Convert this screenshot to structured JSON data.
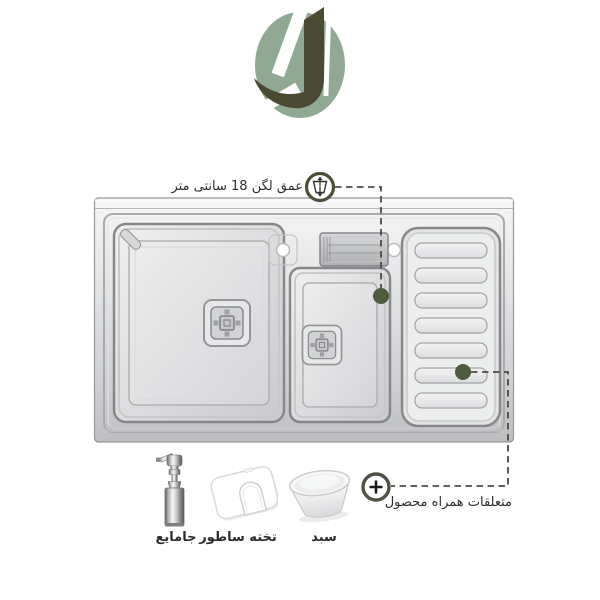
{
  "brand": {
    "logo_letter": "J",
    "logo_color_dark": "#4A4A33",
    "logo_color_sage": "#90A992"
  },
  "product": {
    "image": "stainless-steel-double-bowl-kitchen-sink-with-drainboard"
  },
  "callouts": {
    "depth": {
      "label": "عمق لگن 18 سانتی متر",
      "icon": "depth-gauge-icon"
    },
    "included": {
      "label": "متعلقات همراه محصول",
      "icon": "plus-icon"
    }
  },
  "accessories": {
    "items": [
      {
        "icon": "soap-dispenser",
        "label": "جامایع"
      },
      {
        "icon": "cutting-board",
        "label": "تخته ساطور"
      },
      {
        "icon": "basket",
        "label": "سبد"
      }
    ]
  },
  "colors": {
    "marker_dot": "#4E5B3E",
    "callout_ring": "#4A4F38",
    "dash_line": "#4B4B4B",
    "steel_light": "#F6F6F7",
    "steel_dark": "#BDBEC0",
    "text": "#2B2B2B",
    "background": "#FFFFFF"
  }
}
